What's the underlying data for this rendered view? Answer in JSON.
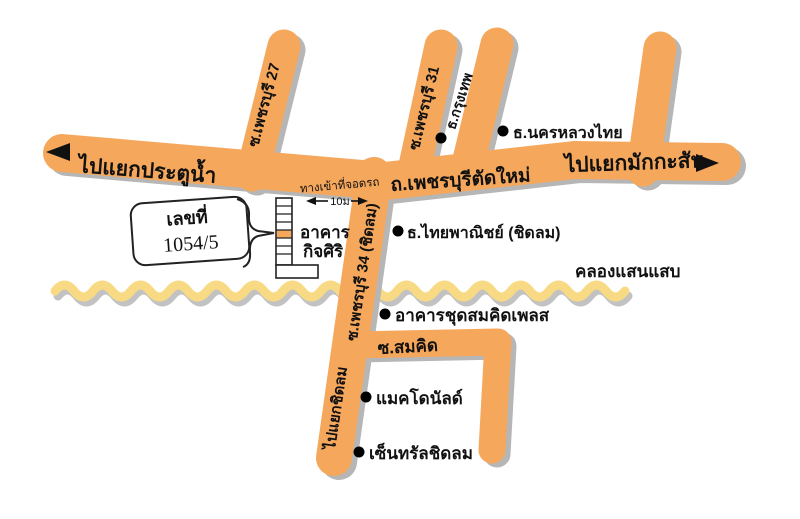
{
  "roads": {
    "main": {
      "name": "ถ.เพชรบุรีตัดใหม่",
      "west_label": "ไปแยกประตูน้ำ",
      "east_label": "ไปแยกมักกะสัน"
    },
    "soi27": {
      "name": "ซ.เพชรบุรี 27"
    },
    "soi31": {
      "name": "ซ.เพชรบุรี 31"
    },
    "soi34": {
      "name": "ซ.เพชรบุรี 34 (ชิดลม)",
      "south_label": "ไปแยกชิดลม"
    },
    "somkid": {
      "name": "ซ.สมคิด"
    }
  },
  "canal": {
    "name": "คลองแสนแสบ"
  },
  "landmarks": [
    {
      "id": "bangkok-bank",
      "label": "ธ.กรุงเทพ"
    },
    {
      "id": "nakornluang-thai-bank",
      "label": "ธ.นครหลวงไทย"
    },
    {
      "id": "thai-panich-bank-chidlom",
      "label": "ธ.ไทยพาณิชย์ (ชิดลม)"
    },
    {
      "id": "somkid-place-condo",
      "label": "อาคารชุดสมคิดเพลส"
    },
    {
      "id": "mcdonalds",
      "label": "แมคโดนัลด์"
    },
    {
      "id": "central-chidlom",
      "label": "เซ็นทรัลชิดลม"
    }
  ],
  "building": {
    "label_line1": "อาคาร",
    "label_line2": "กิจศิริ"
  },
  "address": {
    "caption": "เลขที่",
    "number": "1054/5"
  },
  "parking": {
    "entrance_label": "ทางเข้าที่จอดรถ",
    "distance": "10ม"
  },
  "colors": {
    "road": "#f5a75c",
    "road_shadow": "#b6b6b6",
    "canal": "#f9da84",
    "canal_shadow": "#c2c2c2",
    "text": "#111111",
    "background": "#ffffff"
  }
}
